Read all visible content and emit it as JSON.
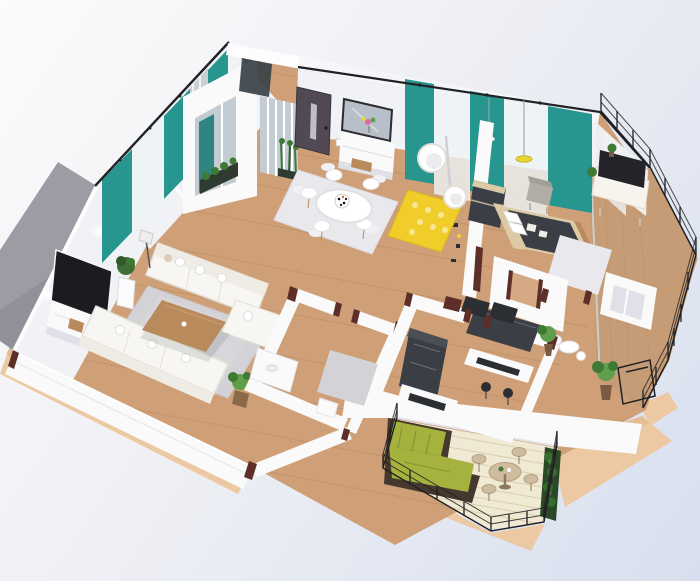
{
  "scene": {
    "type": "isometric-3d-apartment-floor-plan-render",
    "view": "dollhouse cutaway from above",
    "rooms": [
      {
        "id": "living-room",
        "objects": [
          "corner-sofa",
          "three-seat-sofa",
          "coffee-table",
          "wall-tv",
          "media-console",
          "gray-shag-rug",
          "floor-plant",
          "wall-lamps",
          "floor-lamp"
        ]
      },
      {
        "id": "entry",
        "objects": [
          "front-door",
          "glass-vestibule",
          "planter-boxes",
          "mirror",
          "console-table",
          "flower-vase"
        ]
      },
      {
        "id": "dining-area",
        "objects": [
          "round-table",
          "white-chairs",
          "white-shag-rug",
          "patterned-centerpiece"
        ]
      },
      {
        "id": "lounge-corner",
        "objects": [
          "hanging-egg-chair",
          "egg-chair",
          "yellow-honeycomb-rug",
          "yellow-pendant-lamp",
          "white-pendant-lamp",
          "gray-armchair",
          "shelf-partition"
        ]
      },
      {
        "id": "bedroom",
        "objects": [
          "double-bed",
          "charcoal-duvet",
          "pillows",
          "headboard-wall",
          "white-shag-rug",
          "tv-sideboard",
          "tv",
          "teal-curtains",
          "wardrobe-frame",
          "ensuite-arch"
        ]
      },
      {
        "id": "bathroom",
        "objects": [
          "vanity",
          "gray-rug",
          "laundry-box"
        ]
      },
      {
        "id": "kitchen-study",
        "objects": [
          "dark-kitchen-unit",
          "vented-cabinet",
          "desk",
          "dark-chairs",
          "breakfast-bar",
          "bar-stools",
          "white-nook-table"
        ]
      },
      {
        "id": "side-balcony",
        "objects": [
          "wood-deck",
          "wire-railing",
          "potted-plants",
          "planter-frame",
          "glass-wall"
        ]
      },
      {
        "id": "terrace",
        "objects": [
          "green-corner-lounge",
          "round-outdoor-table",
          "outdoor-chairs",
          "hedge-planter",
          "wire-railing",
          "pale-deck"
        ]
      }
    ],
    "walls": [
      "teal-and-sheer-curtain-walls",
      "gray-exterior-west-wall",
      "white-cut-walls",
      "maroon-cut-edges",
      "black-curtain-rails"
    ],
    "base": "tan-wood-plinth"
  },
  "colors": {
    "bg_top": "#fbfbfc",
    "bg_bottom": "#d7dfee",
    "plinth": "#ecc9a2",
    "plinth_shade": "#deb184",
    "floor": "#cfa077",
    "floor_line": "#b98a5f",
    "deck": "#f0e9d4",
    "deck_line": "#d9cfae",
    "balcony_deck": "#c59c75",
    "wall_white": "#fafafa",
    "wall_face": "#f1f2f6",
    "wall_shadow": "#dfe0e8",
    "wall_gray": "#9c9ca4",
    "wall_gray_dark": "#84848d",
    "cut_edge": "#5e2f28",
    "teal": "#27968f",
    "teal_dark": "#1e7d78",
    "sheer": "#eef2f6",
    "door": "#514a55",
    "charcoal": "#3b3e44",
    "dark": "#2b2e32",
    "glass": "#c3ccd3",
    "mirror": "#b7bfc8",
    "rug_gray": "#d3d3d7",
    "rug_light": "#e9e9ed",
    "rug_yellow": "#f0cd29",
    "sofa": "#f7f6f2",
    "sofa_shadow": "#e3e0d8",
    "wood": "#b98a5c",
    "wood_light": "#dcc9a6",
    "olive": "#a6b23e",
    "olive_dark": "#76812d",
    "frame_brown": "#46382e",
    "hedge": "#2b4827",
    "plant": "#5f9e4a",
    "plant_dark": "#3e7a33",
    "rail": "#202124",
    "beige": "#cfbb9e",
    "yellow": "#e8d435"
  }
}
